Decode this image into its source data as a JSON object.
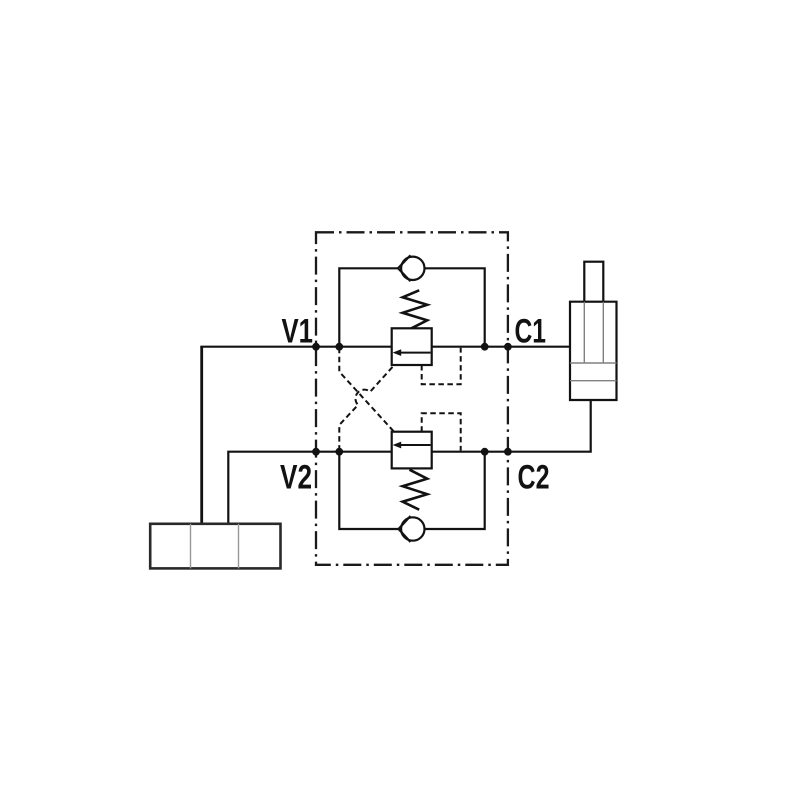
{
  "schematic": {
    "kind": "hydraulic-circuit-diagram",
    "port_labels": {
      "v1": "V1",
      "v2": "V2",
      "c1": "C1",
      "c2": "C2"
    },
    "colors": {
      "background": "#ffffff",
      "line": "#121212",
      "light_line": "#808080",
      "divider_line": "#999999"
    },
    "icons": [
      "valve-assembly-boundary",
      "check-valve-top-icon",
      "counterbalance-valve-top-icon",
      "spring-top-icon",
      "counterbalance-valve-bottom-icon",
      "spring-bottom-icon",
      "check-valve-bottom-icon",
      "pilot-line-cross",
      "hydraulic-cylinder-icon",
      "directional-valve-block-icon"
    ]
  }
}
